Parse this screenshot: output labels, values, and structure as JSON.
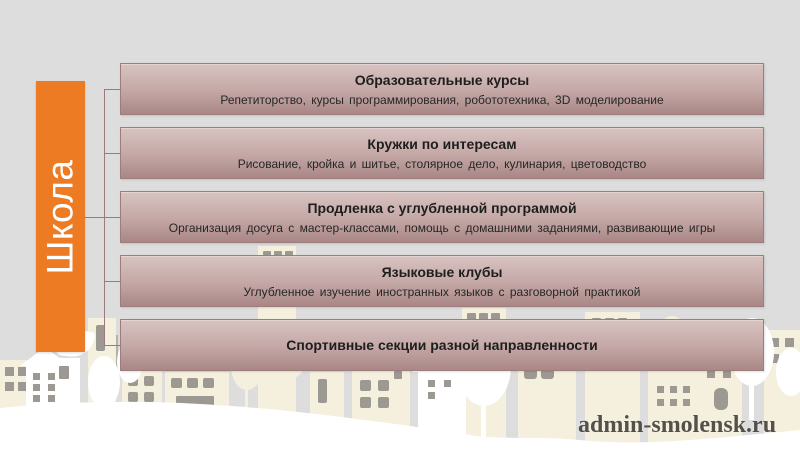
{
  "slide": {
    "banner_label": "Школа",
    "watermark": "admin-smolensk.ru",
    "boxes": [
      {
        "title": "Образовательные курсы",
        "subtitle": "Репетиторство, курсы программирования, робототехника, 3D моделирование"
      },
      {
        "title": "Кружки по интересам",
        "subtitle": "Рисование, кройка и шитье, столярное дело, кулинария, цветоводство"
      },
      {
        "title": "Продленка с углубленной программой",
        "subtitle": "Организация досуга с мастер-классами, помощь с домашними заданиями, развивающие игры"
      },
      {
        "title": "Языковые клубы",
        "subtitle": "Углубленное изучение иностранных языков с разговорной практикой"
      },
      {
        "title": "Спортивные секции разной направленности",
        "subtitle": ""
      }
    ],
    "colors": {
      "background": "#DEDDDD",
      "accent_orange": "#ED7B23",
      "banner_text": "#FFFFFF",
      "box_border": "#9D7C7C",
      "box_gradient_top": "#D8C3C1",
      "box_gradient_bottom": "#A98786",
      "box_title_text": "#1E1E1E",
      "box_subtitle_text": "#262626",
      "connector": "#997B7B",
      "skyline_cream": "#F5EFDD",
      "skyline_window": "#9C9992",
      "skyline_white": "#FFFFFF",
      "watermark_text": "#3E3C38"
    }
  }
}
